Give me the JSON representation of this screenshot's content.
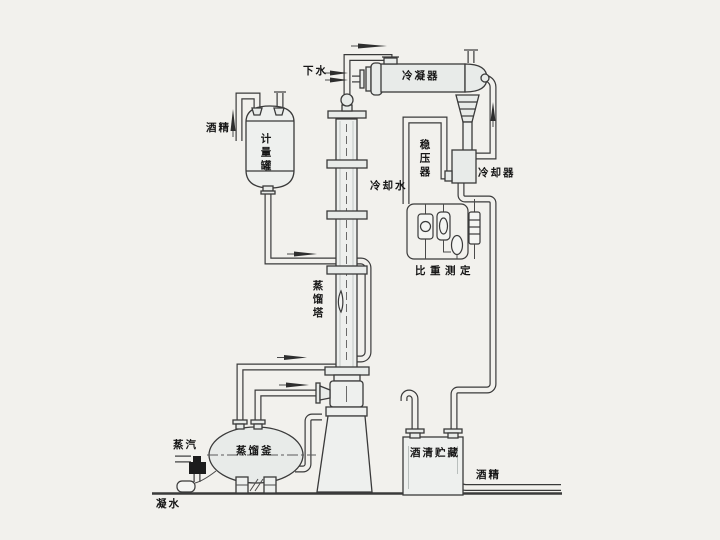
{
  "labels": {
    "drain_water": "下水",
    "condenser": "冷凝器",
    "alcohol_in": "酒精",
    "measuring_tank": "计量罐",
    "pressure_stabilizer": "稳压器",
    "cooling_water": "冷却水",
    "cooler": "冷却器",
    "density_measurement": "比重测定",
    "distillation_column": "蒸馏塔",
    "distillation_kettle": "蒸馏釜",
    "steam": "蒸汽",
    "condensate": "凝水",
    "alcohol_storage": "酒清贮藏",
    "alcohol_out": "酒精"
  },
  "colors": {
    "background": "#f2f1ed",
    "line": "#3a3a3a",
    "vessel_fill": "#e8ebe9",
    "text": "#161616"
  }
}
